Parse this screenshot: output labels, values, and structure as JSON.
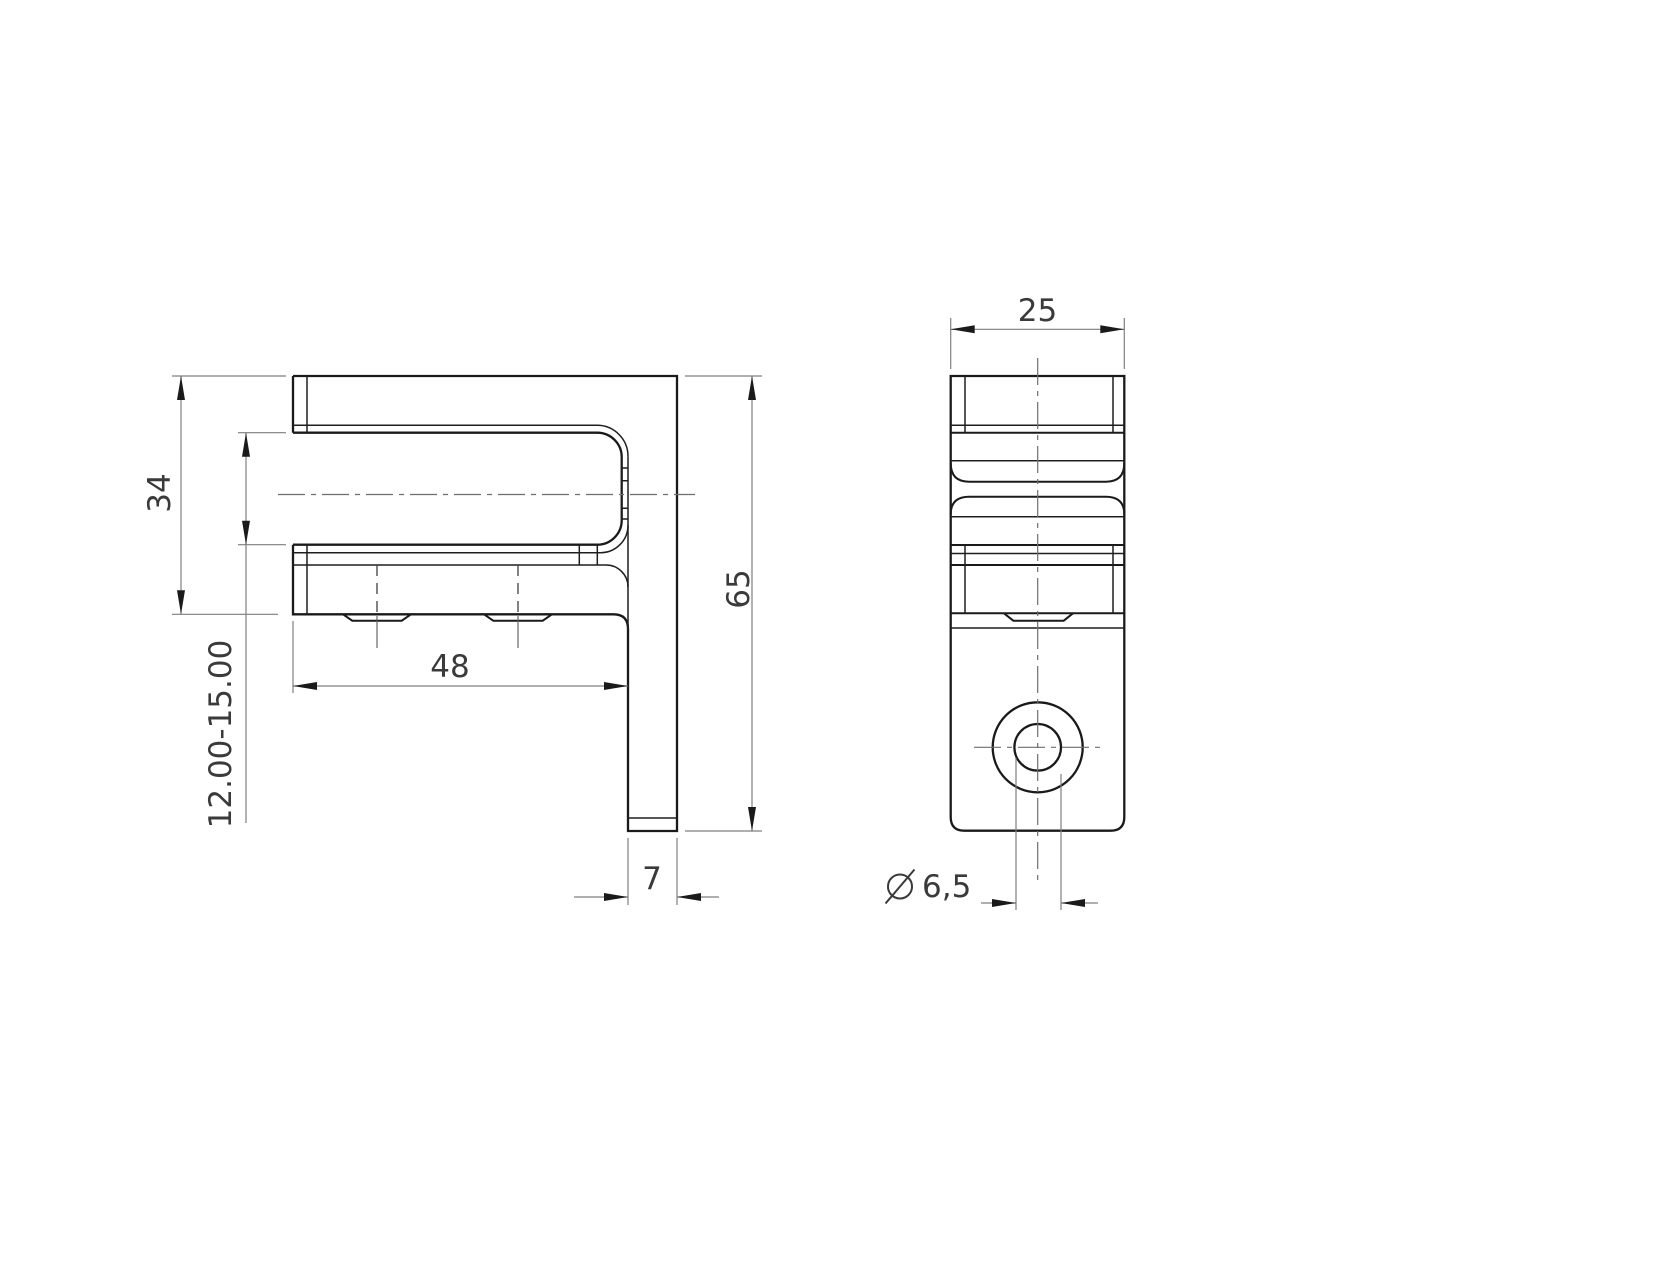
{
  "page": {
    "background": "#ffffff"
  },
  "drawing": {
    "type": "technical-drawing",
    "views": {
      "side_view": {
        "name": "side-view",
        "dimensions": {
          "clamp_height": "34",
          "clamp_opening_range": "12.00-15.00",
          "body_width": "48",
          "overall_height": "65",
          "leg_thickness": "7"
        }
      },
      "front_view": {
        "name": "front-view",
        "dimensions": {
          "body_depth": "25",
          "hole_diameter": "6,5",
          "hole_diameter_prefix_icon": "diameter-symbol-icon"
        }
      }
    },
    "colors": {
      "outline": "#1a1a1a",
      "dimension_lines": "#7f7f7f",
      "text": "#3a3a3a",
      "background": "#ffffff"
    }
  }
}
